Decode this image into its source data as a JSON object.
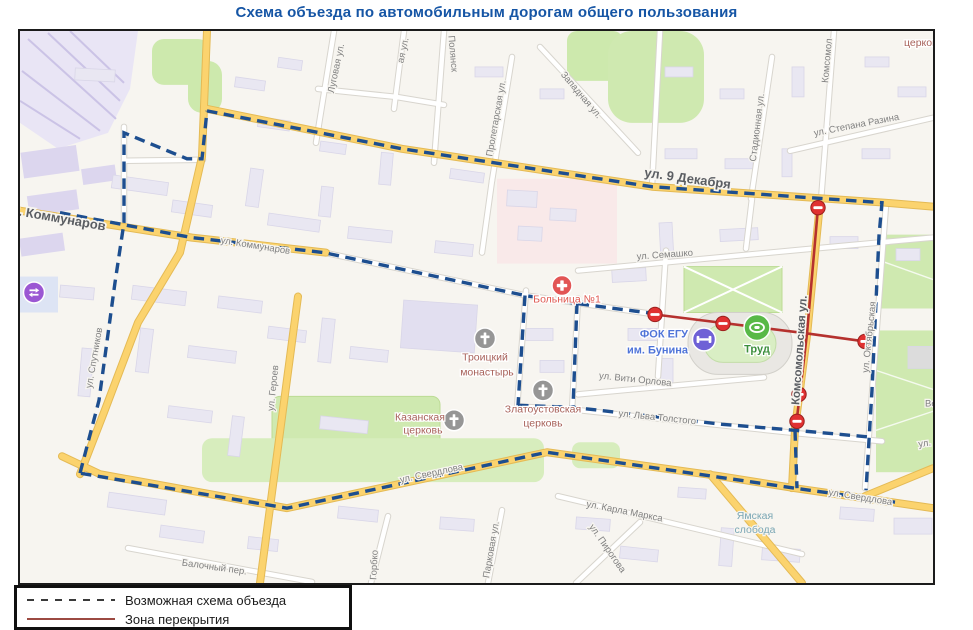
{
  "title": "Схема объезда по автомобильным дорогам общего пользования",
  "legend": {
    "detour_label": "Возможная схема объезда",
    "closure_label": "Зона перекрытия"
  },
  "colors": {
    "title_blue": "#1555a5",
    "detour_dash_blue": "#1d4e8f",
    "closure_red": "#b5312e",
    "legend_closure_line": "#9c4a42",
    "major_road_yellow": "#fbd36e",
    "park_green": "#cfe9b0",
    "building_fill": "#e9e7f2"
  },
  "icons": {
    "no-entry-icon": "red circle with white bar",
    "hospital-icon": "red circle with white cross",
    "church-icon": "gray circle with white cross",
    "fitness-icon": "purple circle with white dumbbell",
    "stadium-icon": "green circle with white stadium ring",
    "transit-station-icon": "purple circle with white arrows"
  },
  "map": {
    "streets": {
      "kommunarov_major": "ул. Коммунаров",
      "kommunarov": "ул. Коммунаров",
      "dekabrya": "ул. 9 Декабря",
      "lugovaya": "Луговая ул.",
      "aya": "ая ул.",
      "polyansk": "Полянск",
      "proletarskaya": "Пролетарская ул.",
      "zapadnaya": "Западная ул.",
      "stadionnaya": "Стадионная ул.",
      "stepana_razina": "ул. Степана Разина",
      "komsomol": "Комсомол",
      "komsomolskaya": "Комсомольская ул.",
      "semashko": "ул. Семашко",
      "viti_orlova": "ул. Вити Орлова",
      "lva_tolstogo": "ул. Льва Толстого",
      "sputnikov": "ул. Спутников",
      "geroev": "ул. Героев",
      "sverdlova_w": "ул. Свердлова",
      "sverdlova_e": "ул. Свердлова",
      "karla_marksa": "ул. Карла Маркса",
      "pirogova": "ул. Пирогова",
      "gorbko": "Горбко",
      "parkovaya": "Парковая ул.",
      "balochny": "Балочный пер.",
      "oktyabrskaya": "ул. Октябрьская",
      "ul_fragment": "ул.",
      "ve_fragment": "Ве"
    },
    "pois": {
      "hospital": "Больница №1",
      "fok1": "ФОК ЕГУ",
      "fok2": "им. Бунина",
      "trud": "Труд",
      "troitsky1": "Троицкий",
      "troitsky2": "монастырь",
      "zlatoust1": "Златоустовская",
      "zlatoust2": "церковь",
      "kazan1": "Казанская",
      "kazan2": "церковь",
      "yamskaya1": "Ямская",
      "yamskaya2": "слобода",
      "church_ne": "церковь"
    }
  }
}
